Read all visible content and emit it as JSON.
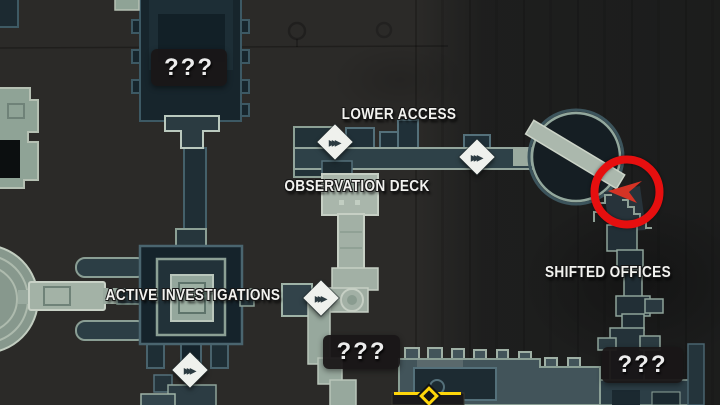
{
  "labels": {
    "lower_access": "LOWER ACCESS",
    "observation_deck": "OBSERVATION DECK",
    "active_investigations": "ACTIVE INVESTIGATIONS",
    "shifted_offices": "SHIFTED OFFICES"
  },
  "unknown_rooms": [
    "???",
    "???",
    "???"
  ],
  "icons": {
    "travel_marker_glyph": "▸▸▸",
    "travel_marker_meaning": "fast-travel-diamond",
    "player_marker_meaning": "red-player-arrow",
    "gate_marker_meaning": "yellow-gate-diamond",
    "highlight_meaning": "red-highlight-circle"
  },
  "colors": {
    "background": "#2b2a28",
    "room_dark_fill": "#17252c",
    "room_light_fill": "#a2b0a5",
    "outline_teal": "#4a656f",
    "outline_sage": "#9fb3a7",
    "corridor_fill": "#2e4148",
    "label_text": "#f2f2ef",
    "badge_bg": "#191617",
    "highlight_red": "#e60f0f",
    "marker_yellow": "#ffd60a"
  }
}
